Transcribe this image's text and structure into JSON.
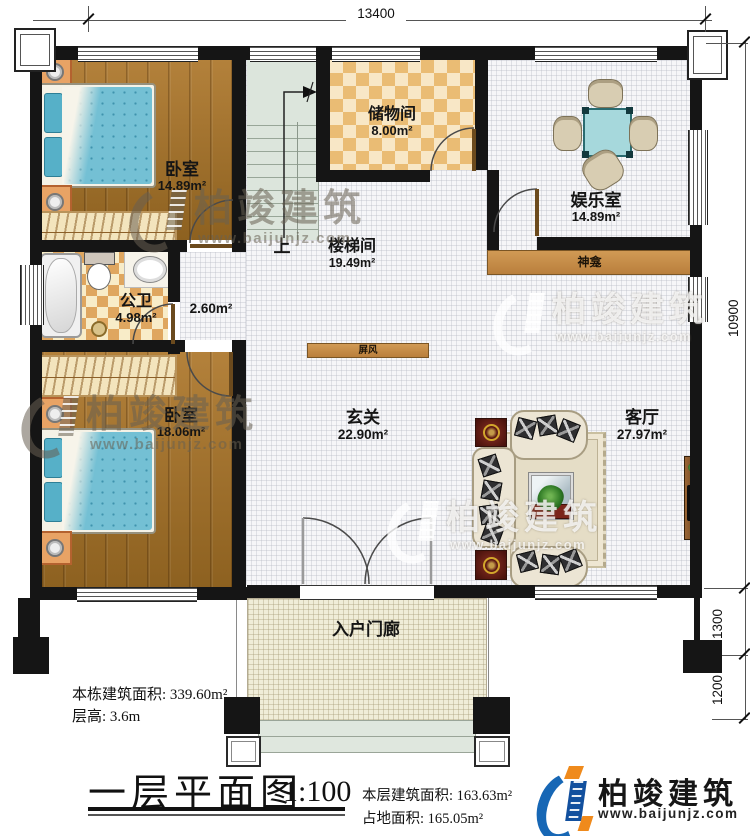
{
  "dims": {
    "top": "13400",
    "right_main": "10900",
    "right_mid": "1300",
    "right_low": "1200"
  },
  "rooms": {
    "bedroom1": {
      "name": "卧室",
      "area": "14.89m²"
    },
    "storage": {
      "name": "储物间",
      "area": "8.00m²"
    },
    "entertainment": {
      "name": "娱乐室",
      "area": "14.89m²"
    },
    "stairwell": {
      "name": "楼梯间",
      "area": "19.49m²"
    },
    "bathroom": {
      "name": "公卫",
      "area": "4.98m²"
    },
    "corridor": {
      "area": "2.60m²"
    },
    "bedroom2": {
      "name": "卧室",
      "area": "18.06m²"
    },
    "foyer": {
      "name": "玄关",
      "area": "22.90m²"
    },
    "living": {
      "name": "客厅",
      "area": "27.97m²"
    },
    "porch": {
      "name": "入户门廊"
    }
  },
  "features": {
    "shrine": "神龛",
    "screen": "屏风",
    "stairs_up": "上"
  },
  "annotations": {
    "building_area": "本栋建筑面积: 339.60m²",
    "floor_height": "层高: 3.6m",
    "floor_area": "本层建筑面积: 163.63m²",
    "footprint_area": "占地面积: 165.05m²"
  },
  "footer": {
    "plan_title": "一层平面图",
    "scale": "1:100"
  },
  "brand": {
    "name": "柏竣建筑",
    "site": "www.baijunjz.com"
  },
  "colors": {
    "wall": "#151515",
    "wood_floor": "#a5762f",
    "tile_checker": "#dfa65f",
    "shrine_bar": "#c89150",
    "stairs": "#dce5dc",
    "bed": "#74c0d4",
    "porch": "#f0edd8",
    "logo_blue": "#1767b5",
    "logo_orange": "#ef8a1c"
  }
}
